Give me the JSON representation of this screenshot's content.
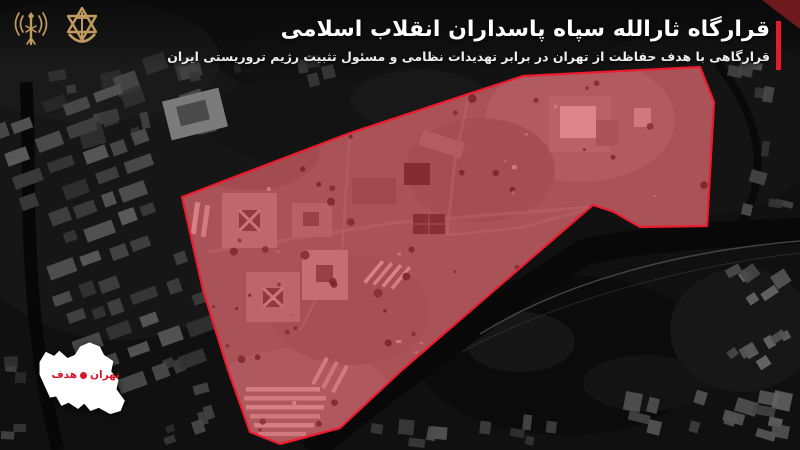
{
  "header": {
    "title": "قرارگاه ثارالله سپاه پاسداران انقلاب اسلامی",
    "subtitle": "قرارگاهی با هدف حفاظت از تهران در برابر تهدیدات نظامی و مسئول تثبیت رژیم تروریستی ایران",
    "accent_color": "#e8192c",
    "logos": [
      {
        "icon": "intel-corps-emblem",
        "color": "#c19a5e"
      },
      {
        "icon": "idf-emblem",
        "color": "#c19a5e"
      }
    ]
  },
  "inset_map": {
    "city_label": "تهران",
    "target_label": "هدف",
    "marker_color": "#d6182a",
    "map_fill": "#ffffff"
  },
  "target_area": {
    "outline_color": "#ec1b2e",
    "fill_color": "#c51926",
    "fill_opacity": "0.5",
    "polygon_points": "182,197 350,133 523,76 700,67 714,102 707,226 640,227 614,212 593,205 402,370 340,428 280,444 250,432 228,370 203,290"
  }
}
